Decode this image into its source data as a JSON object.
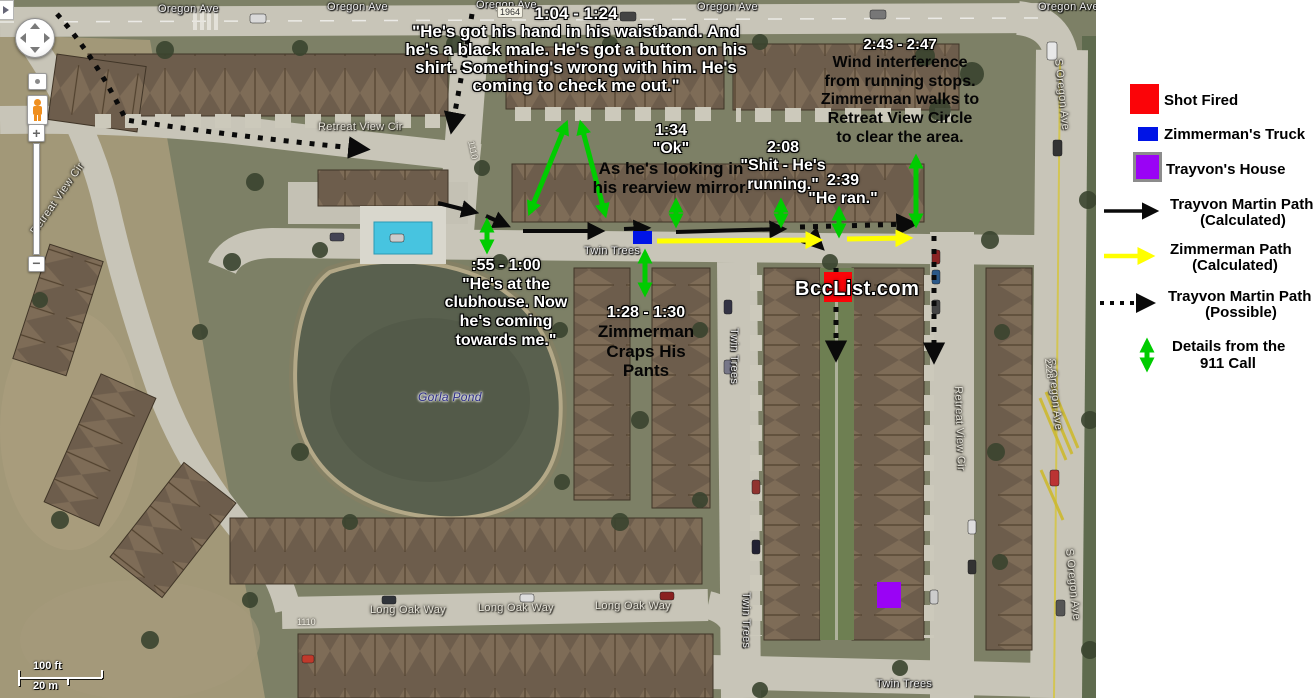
{
  "legend": {
    "items": [
      {
        "id": "shot-fired",
        "label": "Shot Fired",
        "color": "#fb0408",
        "swatch": "square"
      },
      {
        "id": "zimmermans-truck",
        "label": "Zimmerman's Truck",
        "color": "#0014e6",
        "swatch": "rect"
      },
      {
        "id": "trayvons-house",
        "label": "Trayvon's House",
        "color": "#9a03f5",
        "swatch": "square-bordered"
      },
      {
        "id": "trayvon-path-calculated",
        "label": "Trayvon Martin Path",
        "sublabel": "(Calculated)",
        "color": "#000000",
        "swatch": "arrow-solid"
      },
      {
        "id": "zimmerman-path-calculated",
        "label": "Zimmerman Path",
        "sublabel": "(Calculated)",
        "color": "#ffff00",
        "swatch": "arrow-solid"
      },
      {
        "id": "trayvon-path-possible",
        "label": "Trayvon Martin Path",
        "sublabel": "(Possible)",
        "color": "#000000",
        "swatch": "arrow-dotted"
      },
      {
        "id": "details-911-call",
        "label": "Details from the",
        "sublabel": "911 Call",
        "color": "#00cc00",
        "swatch": "arrow-double-vertical"
      }
    ]
  },
  "annotations": {
    "a104": {
      "time": "1:04 - 1:24",
      "lines": [
        "\"He's got his hand in his waistband. And",
        "he's a black male. He's got a button on his",
        "shirt. Something's wrong with him. He's",
        "coming to check me out.\""
      ]
    },
    "a243": {
      "time": "2:43 - 2:47",
      "lines": [
        "Wind interference",
        "from running stops.",
        "Zimmerman walks to",
        "Retreat View Circle",
        "to clear the area."
      ]
    },
    "a134": {
      "time": "1:34",
      "quote": "\"Ok\"",
      "lines": [
        "As he's looking in",
        "his rearview mirror."
      ]
    },
    "a208": {
      "time": "2:08",
      "lines": [
        "\"Shit - He's",
        "running.\""
      ]
    },
    "a239": {
      "time": "2:39",
      "lines": [
        "\"He ran.\""
      ]
    },
    "a055": {
      "time": ":55 - 1:00",
      "lines": [
        "\"He's at the",
        "clubhouse. Now",
        "he's coming",
        "towards me.\""
      ]
    },
    "a128": {
      "time": "1:28 - 1:30",
      "lines": [
        "Zimmerman",
        "Craps His",
        "Pants"
      ]
    },
    "watermark": "BccList.com"
  },
  "map_labels": {
    "oregon_ave": "Oregon Ave",
    "s_oregon_ave": "S Oregon Ave",
    "retreat_view_cir": "Retreat View Cir",
    "twin_trees": "Twin Trees",
    "long_oak_way": "Long Oak Way",
    "gorla_pond": "Gorla Pond",
    "num_1964": "1964",
    "num_1110": "1110",
    "num_2228": "2228"
  },
  "markers": {
    "shot_fired_color": "#fb0408",
    "truck_color": "#0014e6",
    "house_color": "#9a03f5",
    "trayvon_path_color": "#000000",
    "zimmerman_path_color": "#ffff00",
    "call_details_color": "#00cc00"
  },
  "controls": {
    "zoom_in": "+",
    "zoom_out": "−",
    "scale_ft": "100 ft",
    "scale_m": "20 m"
  }
}
